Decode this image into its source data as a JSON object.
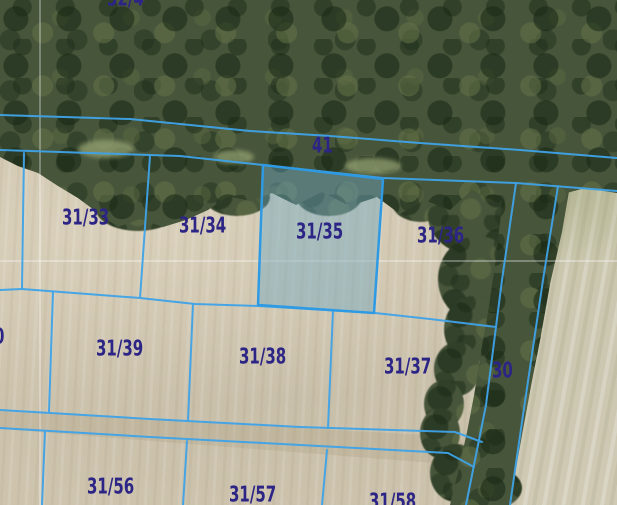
{
  "map": {
    "description": "Cadastral parcel boundary overlay on aerial imagery",
    "highlighted_parcel": "31/35",
    "colors": {
      "boundary_line": "#3fa3e8",
      "highlight_stroke": "#2e9ae4",
      "highlight_fill": "rgba(110,168,192,0.45)",
      "label_text": "#2c2585",
      "grid_line": "rgba(255,255,255,0.5)",
      "field": "#cfc5af",
      "forest": "#47553b"
    },
    "parcels": [
      {
        "label": "32/4",
        "x": 107,
        "y": -12,
        "partial": true,
        "highlighted": false
      },
      {
        "label": "41",
        "x": 312,
        "y": 135,
        "partial": false,
        "highlighted": false
      },
      {
        "label": "31/33",
        "x": 62,
        "y": 207,
        "partial": false,
        "highlighted": false
      },
      {
        "label": "31/34",
        "x": 179,
        "y": 215,
        "partial": false,
        "highlighted": false
      },
      {
        "label": "31/35",
        "x": 296,
        "y": 221,
        "partial": false,
        "highlighted": true
      },
      {
        "label": "31/36",
        "x": 417,
        "y": 225,
        "partial": false,
        "highlighted": false
      },
      {
        "label": "30",
        "x": 492,
        "y": 360,
        "partial": false,
        "highlighted": false
      },
      {
        "label": "0",
        "x": -6,
        "y": 326,
        "partial": true,
        "highlighted": false
      },
      {
        "label": "31/39",
        "x": 96,
        "y": 338,
        "partial": false,
        "highlighted": false
      },
      {
        "label": "31/38",
        "x": 239,
        "y": 346,
        "partial": false,
        "highlighted": false
      },
      {
        "label": "31/37",
        "x": 384,
        "y": 356,
        "partial": false,
        "highlighted": false
      },
      {
        "label": "31/56",
        "x": 87,
        "y": 476,
        "partial": false,
        "highlighted": false
      },
      {
        "label": "31/57",
        "x": 229,
        "y": 484,
        "partial": false,
        "highlighted": false
      },
      {
        "label": "31/58",
        "x": 369,
        "y": 491,
        "partial": true,
        "highlighted": false
      }
    ]
  }
}
